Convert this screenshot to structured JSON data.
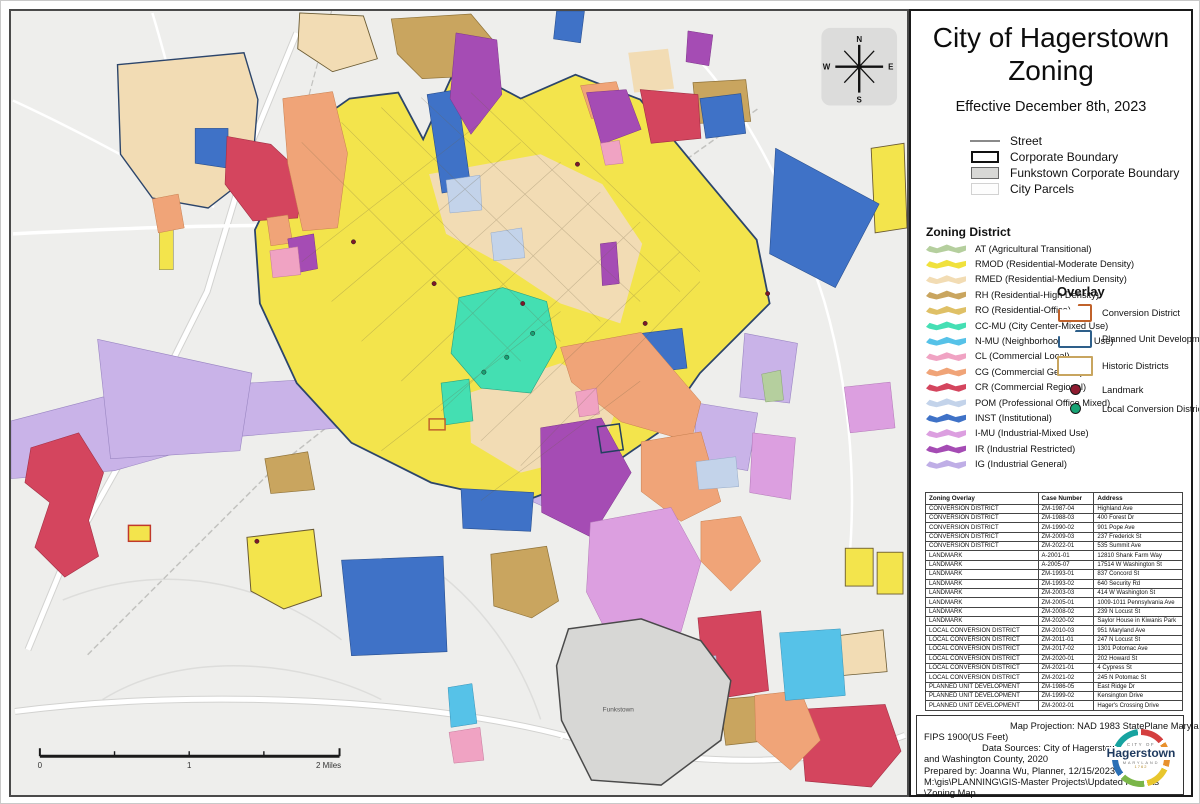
{
  "panel": {
    "title_line1": "City of Hagerstown",
    "title_line2": "Zoning",
    "effective_date": "Effective December 8th, 2023",
    "boundary_legend": {
      "street": "Street",
      "corporate": "Corporate Boundary",
      "funkstown": "Funkstown Corporate Boundary",
      "parcels": "City Parcels"
    },
    "zoning": {
      "header": "Zoning District",
      "items": [
        {
          "label": "AT (Agricultural Transitional)",
          "color": "#b5cf9e"
        },
        {
          "label": "RMOD (Residential-Moderate Density)",
          "color": "#f0e13d"
        },
        {
          "label": "RMED (Residential-Medium Density)",
          "color": "#f2dcb4"
        },
        {
          "label": "RH (Residential-High Density)",
          "color": "#c9a55f"
        },
        {
          "label": "RO (Residential-Office)",
          "color": "#dfc066"
        },
        {
          "label": "CC-MU (City Center-Mixed Use)",
          "color": "#45dfb4"
        },
        {
          "label": "N-MU (Neighborhood-Mixed Use)",
          "color": "#56c2e8"
        },
        {
          "label": "CL (Commercial Local)",
          "color": "#f0a3c3"
        },
        {
          "label": "CG (Commercial General)",
          "color": "#f0a478"
        },
        {
          "label": "CR (Commercial Regional)",
          "color": "#d4455e"
        },
        {
          "label": "POM (Professional Office Mixed)",
          "color": "#c3d3ea"
        },
        {
          "label": "INST (Institutional)",
          "color": "#3f72c7"
        },
        {
          "label": "I-MU (Industrial-Mixed Use)",
          "color": "#dc9fe0"
        },
        {
          "label": "IR (Industrial Restricted)",
          "color": "#a54cb4"
        },
        {
          "label": "IG (Industrial General)",
          "color": "#bfaee6"
        }
      ]
    },
    "overlay": {
      "header": "Overlay",
      "conversion": {
        "label": "Conversion District",
        "color": "#c0622b"
      },
      "pud": {
        "label": "Planned Unit Development",
        "color": "#2e5f8a"
      },
      "historic": {
        "label": "Historic Districts",
        "color": "#c8a55f"
      },
      "landmark": {
        "label": "Landmark",
        "color": "#8e1b30"
      },
      "local": {
        "label": "Local Conversion District",
        "color": "#17a374"
      }
    },
    "table": {
      "headers": [
        "Zoning Overlay",
        "Case Number",
        "Address"
      ],
      "rows": [
        {
          "overlay": "CONVERSION DISTRICT",
          "case": "ZM-1987-04",
          "address": "Highland Ave"
        },
        {
          "overlay": "CONVERSION DISTRICT",
          "case": "ZM-1988-03",
          "address": "400 Forest Dr"
        },
        {
          "overlay": "CONVERSION DISTRICT",
          "case": "ZM-1990-02",
          "address": "901 Pope Ave"
        },
        {
          "overlay": "CONVERSION DISTRICT",
          "case": "ZM-2009-03",
          "address": "237 Frederick St"
        },
        {
          "overlay": "CONVERSION DISTRICT",
          "case": "ZM-2022-01",
          "address": "535 Summit Ave"
        },
        {
          "overlay": "LANDMARK",
          "case": "A-2001-01",
          "address": "12810 Shank Farm Way"
        },
        {
          "overlay": "LANDMARK",
          "case": "A-2005-07",
          "address": "17514 W Washington St"
        },
        {
          "overlay": "LANDMARK",
          "case": "ZM-1993-01",
          "address": "837 Concord St"
        },
        {
          "overlay": "LANDMARK",
          "case": "ZM-1993-02",
          "address": "640 Security Rd"
        },
        {
          "overlay": "LANDMARK",
          "case": "ZM-2003-03",
          "address": "414 W Washington St"
        },
        {
          "overlay": "LANDMARK",
          "case": "ZM-2005-01",
          "address": "1009-1011 Pennsylvania Ave"
        },
        {
          "overlay": "LANDMARK",
          "case": "ZM-2008-02",
          "address": "239 N Locust St"
        },
        {
          "overlay": "LANDMARK",
          "case": "ZM-2020-02",
          "address": "Saylor House in Kiwanis Park"
        },
        {
          "overlay": "LOCAL CONVERSION DISTRICT",
          "case": "ZM-2010-03",
          "address": "951 Maryland Ave"
        },
        {
          "overlay": "LOCAL CONVERSION DISTRICT",
          "case": "ZM-2011-01",
          "address": "247 N Locust St"
        },
        {
          "overlay": "LOCAL CONVERSION DISTRICT",
          "case": "ZM-2017-02",
          "address": "1301 Potomac Ave"
        },
        {
          "overlay": "LOCAL CONVERSION DISTRICT",
          "case": "ZM-2020-01",
          "address": "202 Howard St"
        },
        {
          "overlay": "LOCAL CONVERSION DISTRICT",
          "case": "ZM-2021-01",
          "address": "4 Cypress St"
        },
        {
          "overlay": "LOCAL CONVERSION DISTRICT",
          "case": "ZM-2021-02",
          "address": "245 N Potomac St"
        },
        {
          "overlay": "PLANNED UNIT DEVELOPMENT",
          "case": "ZM-1986-05",
          "address": "East Ridge Dr"
        },
        {
          "overlay": "PLANNED UNIT DEVELOPMENT",
          "case": "ZM-1999-02",
          "address": "Kensington Drive"
        },
        {
          "overlay": "PLANNED UNIT DEVELOPMENT",
          "case": "ZM-2002-01",
          "address": "Hager's Crossing Drive"
        }
      ]
    },
    "info": {
      "lines": [
        "Map Projection: NAD 1983 StatePlane Maryland",
        "FIPS 1900(US Feet)",
        "Data Sources: City of Hagerstown, 2023",
        "and Washington County, 2020",
        "Prepared by: Joanna Wu, Planner, 12/15/2023",
        "M:\\gis\\PLANNING\\GIS-Master Projects\\Updated Projects",
        "\\Zoning Map"
      ]
    },
    "logo": {
      "city_of": "CITY OF",
      "name": "Hagerstown",
      "state": "MARYLAND",
      "year": "1762"
    }
  },
  "map": {
    "funkstown_label": "Funkstown",
    "compass": {
      "n": "N",
      "s": "S",
      "e": "E",
      "w": "W"
    },
    "scale": {
      "zero": "0",
      "one": "1",
      "two": "2 Miles"
    }
  }
}
